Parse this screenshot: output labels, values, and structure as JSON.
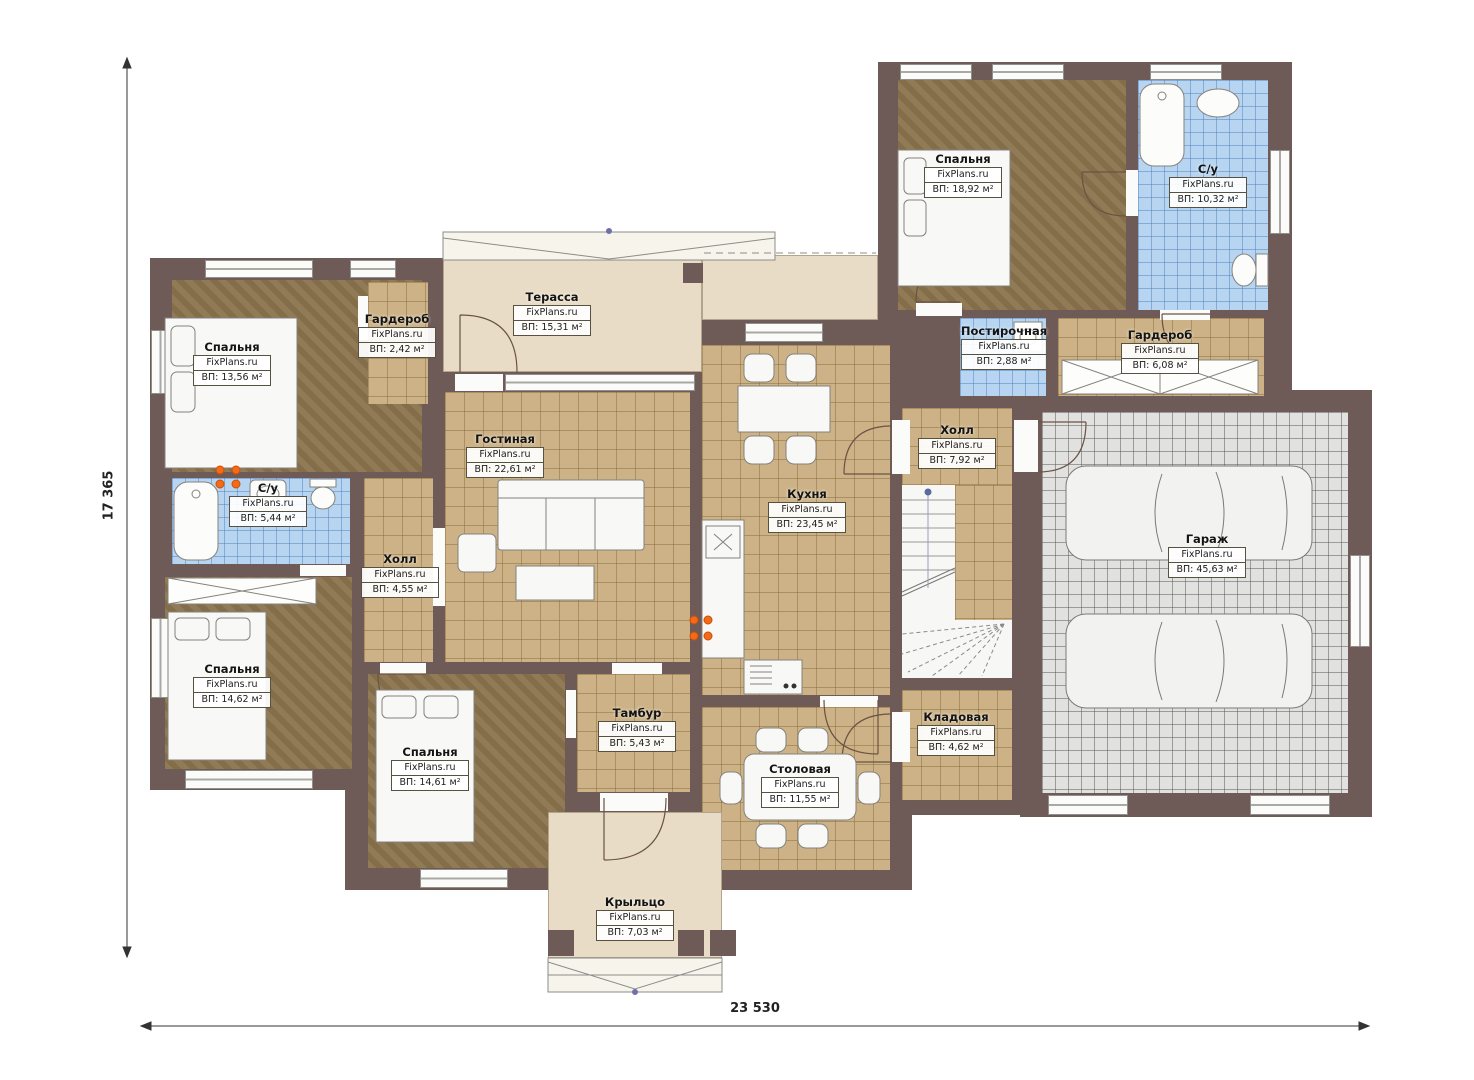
{
  "plan": {
    "watermark": "FixPlans.ru",
    "dimensions": {
      "vertical": "17 365",
      "horizontal": "23 530"
    },
    "rooms": {
      "bed1": {
        "name": "Спальня",
        "area": "ВП: 13,56 м²"
      },
      "ward1": {
        "name": "Гардероб",
        "area": "ВП: 2,42 м²"
      },
      "terrace": {
        "name": "Терасса",
        "area": "ВП: 15,31 м²"
      },
      "bed2": {
        "name": "Спальня",
        "area": "ВП: 18,92 м²"
      },
      "su2": {
        "name": "С/у",
        "area": "ВП: 10,32 м²"
      },
      "laundry": {
        "name": "Постирочная",
        "area": "ВП: 2,88 м²"
      },
      "ward2": {
        "name": "Гардероб",
        "area": "ВП: 6,08 м²"
      },
      "hall2": {
        "name": "Холл",
        "area": "ВП: 7,92 м²"
      },
      "living": {
        "name": "Гостиная",
        "area": "ВП: 22,61 м²"
      },
      "kitchen": {
        "name": "Кухня",
        "area": "ВП: 23,45 м²"
      },
      "su1": {
        "name": "С/у",
        "area": "ВП: 5,44 м²"
      },
      "hall1": {
        "name": "Холл",
        "area": "ВП: 4,55 м²"
      },
      "bed3": {
        "name": "Спальня",
        "area": "ВП: 14,62 м²"
      },
      "bed4": {
        "name": "Спальня",
        "area": "ВП: 14,61 м²"
      },
      "tambour": {
        "name": "Тамбур",
        "area": "ВП: 5,43 м²"
      },
      "dining": {
        "name": "Столовая",
        "area": "ВП: 11,55 м²"
      },
      "storage": {
        "name": "Кладовая",
        "area": "ВП: 4,62 м²"
      },
      "garage": {
        "name": "Гараж",
        "area": "ВП: 45,63 м²"
      },
      "porch": {
        "name": "Крыльцо",
        "area": "ВП: 7,03 м²"
      }
    },
    "colors": {
      "wall": "#6e5b58",
      "carpet": "#8b744d",
      "tile": "#ccb286",
      "bath_tile": "#b7d5f1",
      "garage_tile": "#e1e1df",
      "outdoor": "#e9dcc6",
      "accent": "#f26a1b"
    }
  }
}
